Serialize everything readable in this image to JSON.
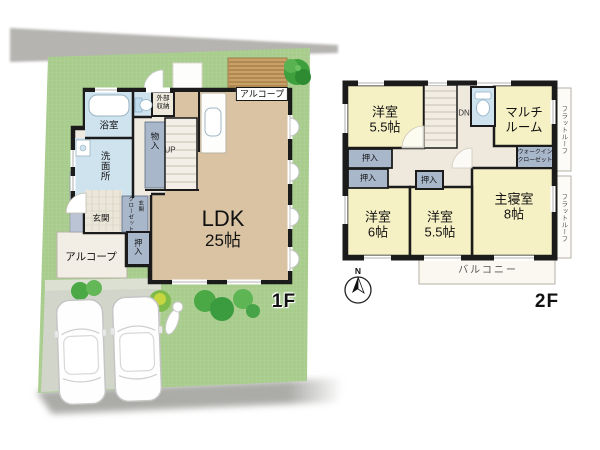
{
  "palette": {
    "lawn": "#a7cc8c",
    "road": "#b5b4b1",
    "parking": "#d2d6ca",
    "wall": "#1b1b1b",
    "floor_wood": "#d9c3a3",
    "floor_hall": "#f0ebe1",
    "room_wet_blue": "#cfe3ef",
    "closet_blue": "#a9b7cb",
    "room_yellow_2f": "#f6f1c5",
    "deck_wood": "#c9a066"
  },
  "icons": {
    "compass": "compass-rose-north",
    "tree": "tree-top-view",
    "bush": "shrub",
    "car": "car-top-view",
    "ornament": "garden-ornament",
    "toilet": "toilet-top-view",
    "bathtub": "bathtub-top-view",
    "sink": "kitchen-sink"
  },
  "floor1": {
    "floor_label": "1F",
    "ldk_name": "LDK",
    "ldk_size": "25帖",
    "bath": "浴室",
    "washroom": "洗面所",
    "storage_mono": "物入",
    "stairs_up": "UP",
    "outer_storage": "外部\n収納",
    "alcove_top": "アルコープ",
    "alcove_bottom": "アルコープ",
    "entrance": "玄関",
    "entrance_closet_word1": "玄関",
    "entrance_closet_word2": "クローゼット",
    "oshiire": "押入"
  },
  "floor2": {
    "floor_label": "2F",
    "room_tl": "洋室\n5.5帖",
    "room_bl": "洋室\n6帖",
    "room_bm": "洋室\n5.5帖",
    "master": "主寝室\n8帖",
    "multi_room": "マルチ\nルーム",
    "wic": "ウォークイン\nクローゼット",
    "oshiire_a": "押入",
    "oshiire_b": "押入",
    "oshiire_c": "押入",
    "stairs_down": "DN",
    "flat_roof_a": "フラットルーフ",
    "flat_roof_b": "フラットルーフ",
    "balcony": "バルコニー",
    "compass_north": "N"
  }
}
